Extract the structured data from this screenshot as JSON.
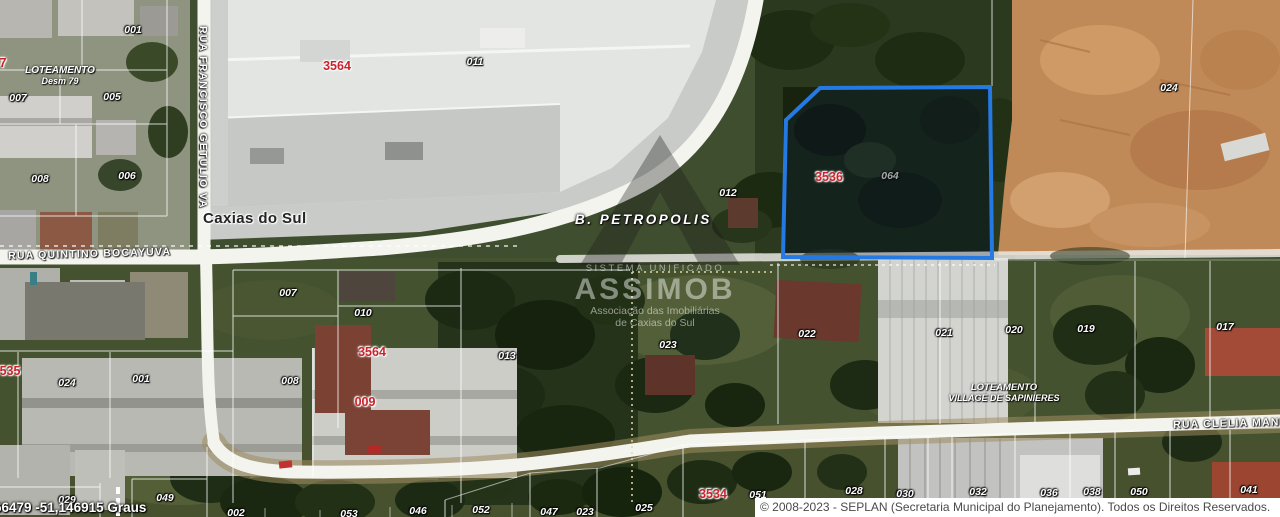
{
  "map": {
    "city": "Caxias do Sul",
    "neighborhood": "B. PETROPOLIS",
    "streets": {
      "francisco_getulio": "RUA FRANCISCO GETULIO VA",
      "quintino_bocayuva": "RUA QUINTINO BOCAYUVA",
      "clelia_manf": "RUA CLELIA MANF"
    },
    "areas": {
      "loteamento_desm": {
        "line1": "LOTEAMENTO",
        "line2": "Desm 79"
      },
      "village_sapinieres": {
        "line1": "LOTEAMENTO",
        "line2": "VILLAGE DE SAPINIERES"
      }
    },
    "parcels_white": [
      {
        "t": "001",
        "x": 133,
        "y": 30
      },
      {
        "t": "007",
        "x": 18,
        "y": 98
      },
      {
        "t": "005",
        "x": 112,
        "y": 97
      },
      {
        "t": "008",
        "x": 40,
        "y": 179
      },
      {
        "t": "006",
        "x": 127,
        "y": 176
      },
      {
        "t": "011",
        "x": 475,
        "y": 62
      },
      {
        "t": "012",
        "x": 728,
        "y": 193
      },
      {
        "t": "024",
        "x": 1169,
        "y": 88
      },
      {
        "t": "064",
        "x": 890,
        "y": 176,
        "cls": "dim"
      },
      {
        "t": "007",
        "x": 288,
        "y": 293
      },
      {
        "t": "010",
        "x": 363,
        "y": 313
      },
      {
        "t": "013",
        "x": 507,
        "y": 356
      },
      {
        "t": "008",
        "x": 290,
        "y": 381
      },
      {
        "t": "023",
        "x": 668,
        "y": 345
      },
      {
        "t": "022",
        "x": 807,
        "y": 334
      },
      {
        "t": "021",
        "x": 944,
        "y": 333
      },
      {
        "t": "020",
        "x": 1014,
        "y": 330
      },
      {
        "t": "019",
        "x": 1086,
        "y": 329
      },
      {
        "t": "017",
        "x": 1225,
        "y": 327
      },
      {
        "t": "024",
        "x": 67,
        "y": 383
      },
      {
        "t": "001",
        "x": 141,
        "y": 379
      },
      {
        "t": "049",
        "x": 165,
        "y": 498
      },
      {
        "t": "029",
        "x": 67,
        "y": 500
      },
      {
        "t": "002",
        "x": 236,
        "y": 513
      },
      {
        "t": "053",
        "x": 349,
        "y": 514
      },
      {
        "t": "046",
        "x": 418,
        "y": 511
      },
      {
        "t": "052",
        "x": 481,
        "y": 510
      },
      {
        "t": "047",
        "x": 549,
        "y": 512
      },
      {
        "t": "023",
        "x": 585,
        "y": 512
      },
      {
        "t": "025",
        "x": 644,
        "y": 508
      },
      {
        "t": "051",
        "x": 758,
        "y": 495
      },
      {
        "t": "028",
        "x": 854,
        "y": 491
      },
      {
        "t": "030",
        "x": 905,
        "y": 494
      },
      {
        "t": "032",
        "x": 978,
        "y": 492
      },
      {
        "t": "036",
        "x": 1049,
        "y": 493
      },
      {
        "t": "038",
        "x": 1092,
        "y": 492
      },
      {
        "t": "050",
        "x": 1139,
        "y": 492
      },
      {
        "t": "041",
        "x": 1249,
        "y": 490
      }
    ],
    "parcels_red": [
      {
        "t": "3564",
        "x": 337,
        "y": 66
      },
      {
        "t": "3536",
        "x": 829,
        "y": 177
      },
      {
        "t": "3564",
        "x": 372,
        "y": 352
      },
      {
        "t": "009",
        "x": 365,
        "y": 402
      },
      {
        "t": "3534",
        "x": 713,
        "y": 494
      },
      {
        "t": "535",
        "x": 10,
        "y": 371
      },
      {
        "t": "7",
        "x": 3,
        "y": 63
      }
    ]
  },
  "watermark": {
    "line1": "SISTEMA UNIFICADO",
    "brand": "ASSIMOB",
    "line3": "Associação das Imobiliárias",
    "line4": "de Caxias do Sul"
  },
  "footer": {
    "coordinates": "66479 -51,146915 Graus",
    "copyright": "© 2008-2023 - SEPLAN (Secretaria Municipal do Planejamento). Todos os Direitos Reservados."
  },
  "colors": {
    "selection_blue": "#2579e2",
    "block_number_red": "#c9232b",
    "road_white": "#f4f4ef",
    "dirt_orange": "#c08a58"
  }
}
